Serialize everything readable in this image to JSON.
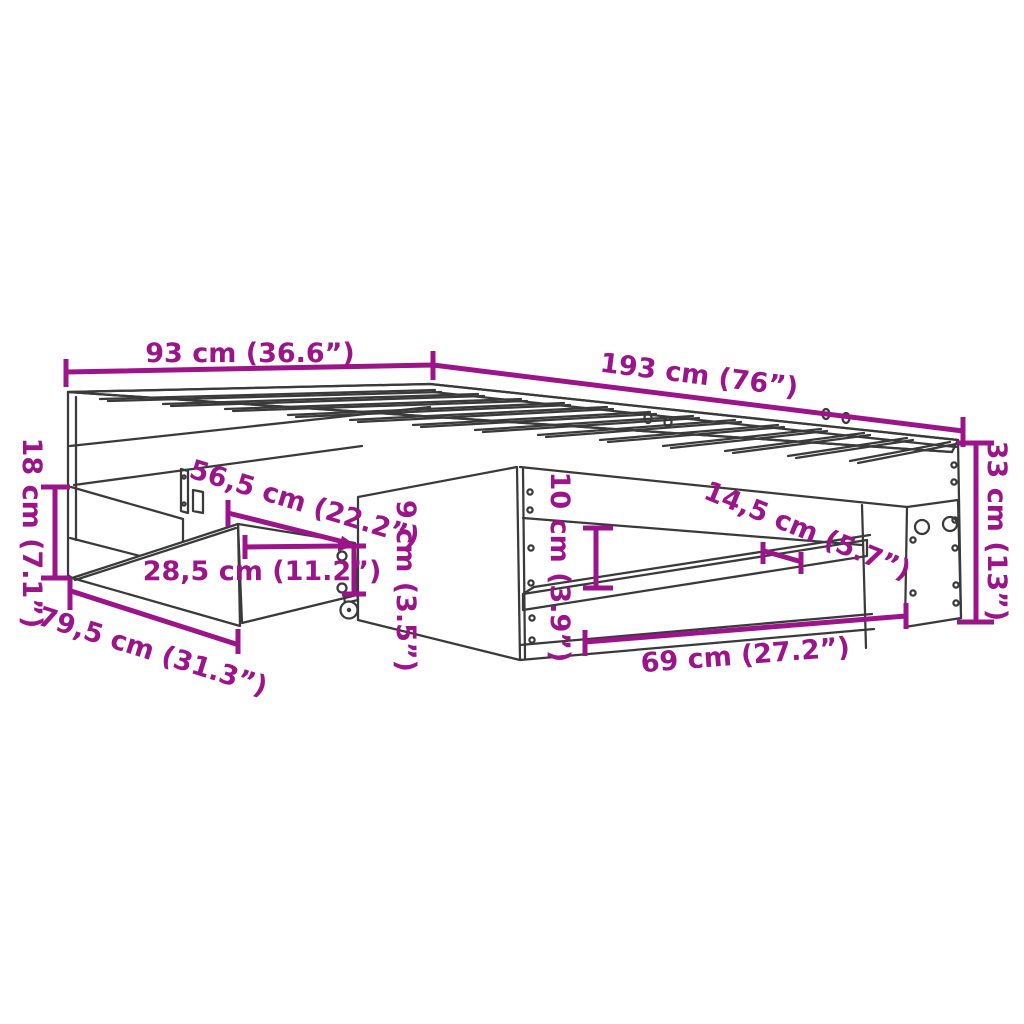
{
  "diagram": {
    "type": "furniture-dimension-diagram",
    "product": "bed frame with pull-out storage drawer on casters",
    "background_color": "#ffffff",
    "dimension_color": "#9c1489",
    "drawing_line_color": "#3a3a3a",
    "dimensions": [
      {
        "id": "bed-width",
        "text": "93 cm (36.6”)"
      },
      {
        "id": "bed-length",
        "text": "193 cm (76”)"
      },
      {
        "id": "base-height",
        "text": "18 cm (7.1”)"
      },
      {
        "id": "drawer-pullout-depth",
        "text": "56,5 cm (22.2”)"
      },
      {
        "id": "drawer-side-depth",
        "text": "28,5 cm (11.2”)"
      },
      {
        "id": "drawer-width",
        "text": "79,5 cm (31.3”)"
      },
      {
        "id": "drawer-height",
        "text": "9 cm (3.5”)"
      },
      {
        "id": "shelf-opening-height",
        "text": "10 cm (3.9”)"
      },
      {
        "id": "shelf-depth",
        "text": "14,5 cm (5.7”)"
      },
      {
        "id": "shelf-opening-width",
        "text": "69 cm (27.2”)"
      },
      {
        "id": "frame-height",
        "text": "33 cm (13”)"
      }
    ]
  }
}
